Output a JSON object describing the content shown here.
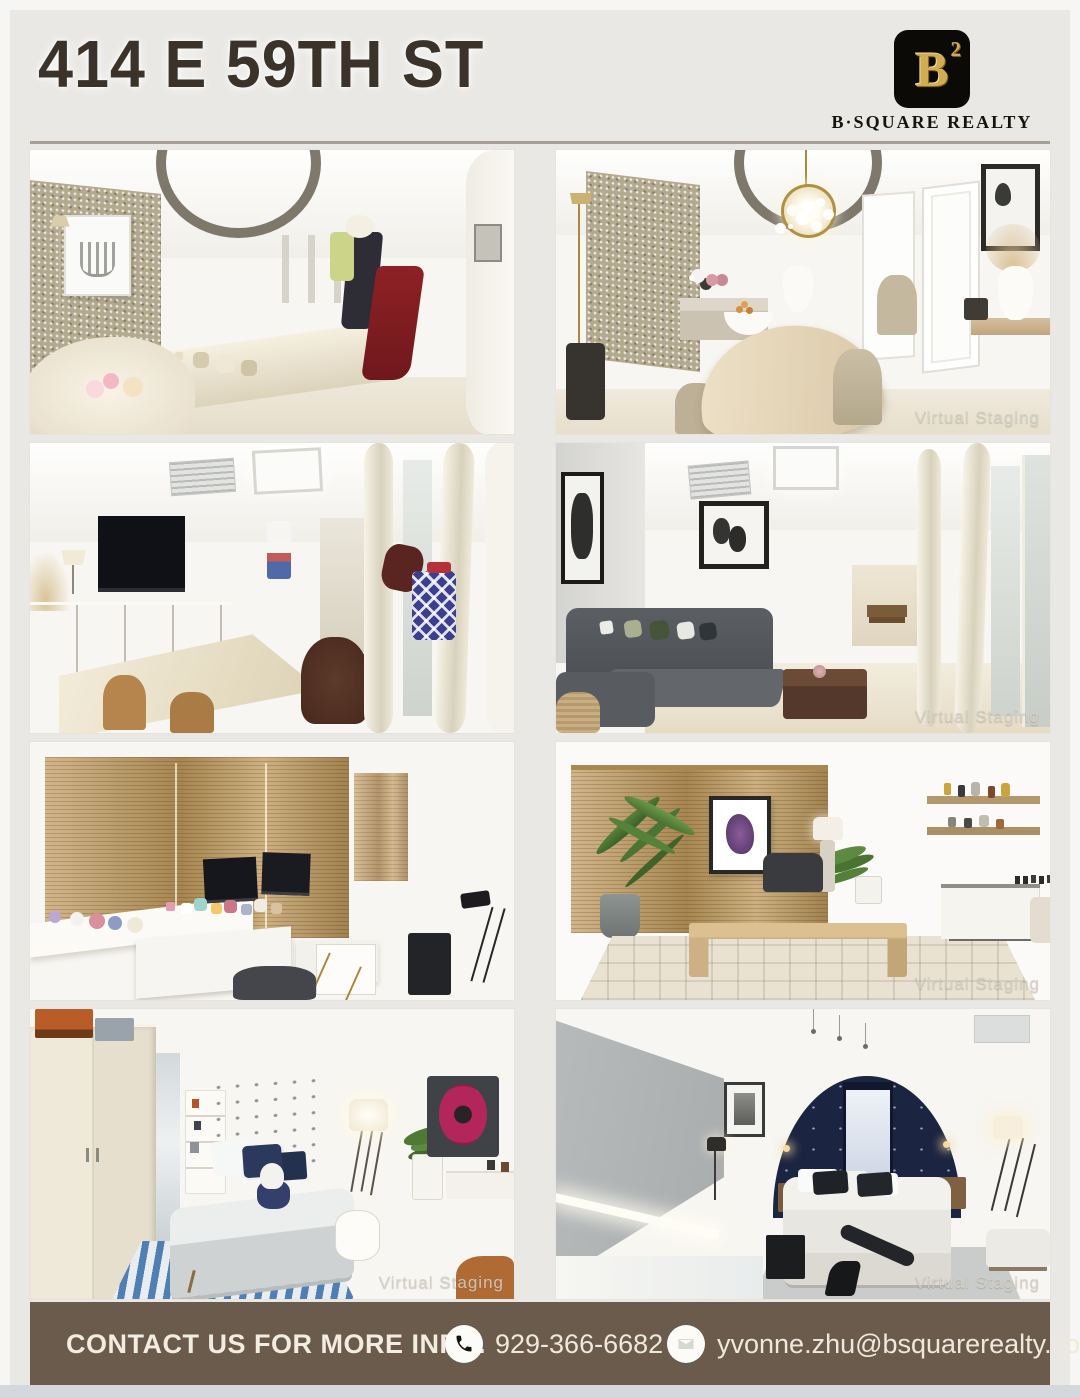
{
  "header": {
    "title": "414 E 59TH ST",
    "logo": {
      "letter": "B",
      "exponent": "2",
      "brand": "B·SQUARE REALTY"
    }
  },
  "gallery": {
    "watermark_text": "Virtual Staging",
    "photos": [
      {
        "name": "living-room-with-chaise-and-coat-rack",
        "watermark": false
      },
      {
        "name": "dining-room-with-pendant-light",
        "watermark": true
      },
      {
        "name": "tv-den-with-wavy-partitions",
        "watermark": false
      },
      {
        "name": "living-room-gray-sectional",
        "watermark": true
      },
      {
        "name": "home-office-desks-and-blinds",
        "watermark": false
      },
      {
        "name": "staged-office-wood-desk",
        "watermark": true
      },
      {
        "name": "bedroom-with-wardrobe-and-striped-rug",
        "watermark": true
      },
      {
        "name": "primary-bedroom-arched-accent-wall",
        "watermark": true
      }
    ]
  },
  "footer": {
    "cta": "CONTACT US FOR MORE INFO.",
    "phone": "929-366-6682",
    "email": "yvonne.zhu@bsquarerealty.com"
  },
  "colors": {
    "background": "#e9e8e5",
    "title_text": "#3b3329",
    "footer_bar": "#6a5b4c",
    "footer_text": "#f2ece1",
    "logo_gold": "#d2ac52",
    "logo_black": "#0c0a07",
    "bottom_strip": "#d4d8dc",
    "grid_rule": "#a5a199"
  }
}
